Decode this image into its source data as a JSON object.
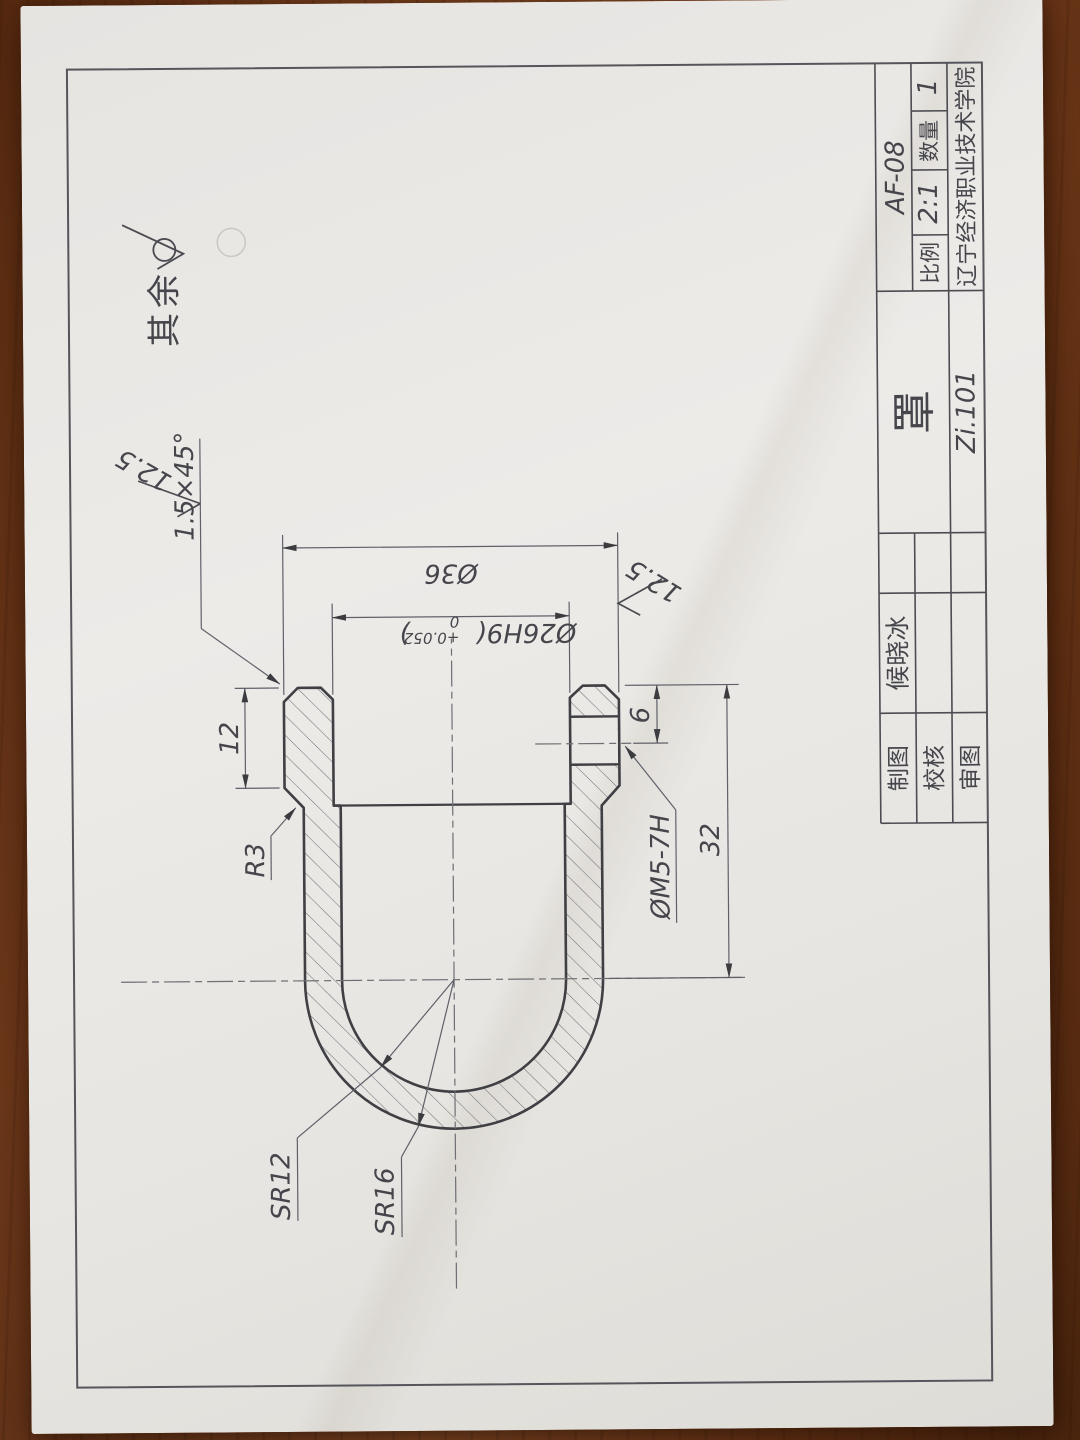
{
  "drawing": {
    "surface_note": "其余",
    "chamfer_note": "1.5×45°",
    "roughness_1": "12.5",
    "roughness_2": "12.5",
    "dim_od": "Ø36",
    "dim_bore_main": "Ø26H9(",
    "dim_bore_tol_upper": "+0.052",
    "dim_bore_tol_lower": "0",
    "dim_bore_close": ")",
    "dim_collar_length": "12",
    "dim_hole_offset": "6",
    "dim_overall": "32",
    "dim_fillet": "R3",
    "dim_sphere_inner": "SR12",
    "dim_sphere_outer": "SR16",
    "thread_note": "ØM5-7H"
  },
  "title_block": {
    "drawn_label": "制图",
    "drawn_name": "候晓冰",
    "check_label": "校核",
    "review_label": "审图",
    "part_name": "罩",
    "drawing_no": "Zi.101",
    "code": "AF-08",
    "scale_label": "比例",
    "scale_value": "2:1",
    "qty_label": "数量",
    "qty_value": "1",
    "org": "辽宁经济职业技术学院"
  }
}
